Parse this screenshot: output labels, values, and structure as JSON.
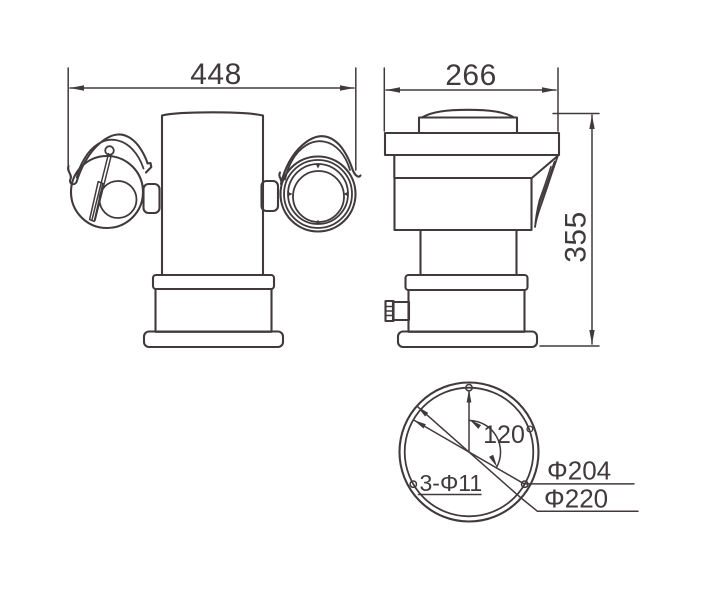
{
  "colors": {
    "line": "#413a3c",
    "background": "#ffffff"
  },
  "views": {
    "front": {
      "width_label": "448"
    },
    "side": {
      "width_label": "266",
      "height_label": "355"
    },
    "bottom": {
      "angle_label": "120°",
      "mount_holes_label": "3-Φ11",
      "bolt_circle_label": "Φ204",
      "base_diameter_label": "Φ220"
    }
  }
}
